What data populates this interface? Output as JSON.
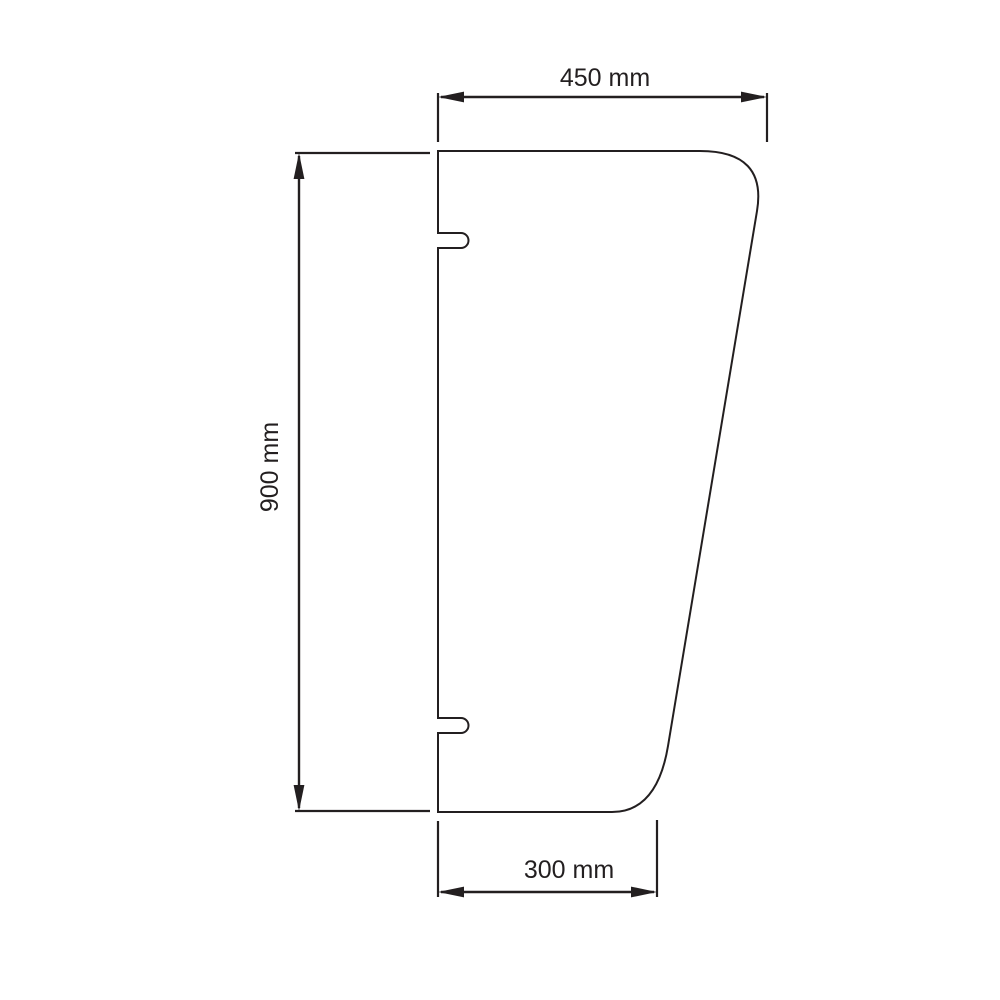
{
  "colors": {
    "background": "#ffffff",
    "line": "#231f20"
  },
  "drawing": {
    "type": "technical-dimension-drawing",
    "shape": "tapered panel with rounded right corners and two mounting slots on left edge",
    "dimensions": {
      "top_width": {
        "label": "450 mm",
        "value": 450,
        "unit": "mm"
      },
      "height": {
        "label": "900 mm",
        "value": 900,
        "unit": "mm"
      },
      "bottom_width": {
        "label": "300 mm",
        "value": 300,
        "unit": "mm"
      }
    }
  }
}
